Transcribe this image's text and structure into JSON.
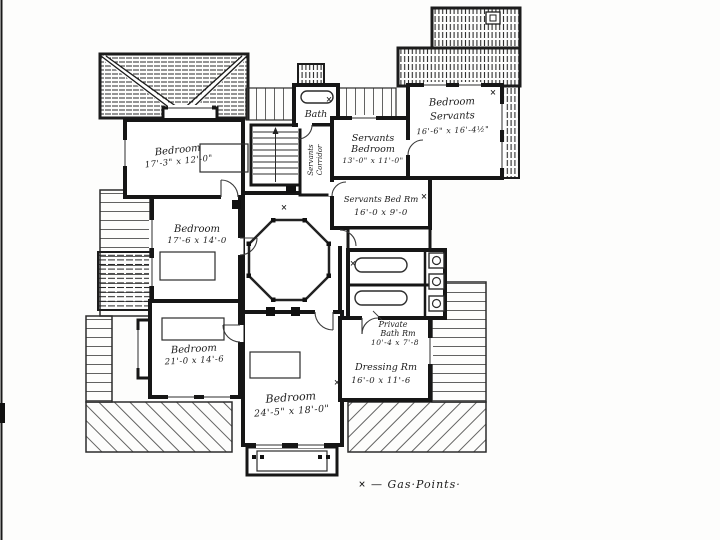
{
  "drawing": {
    "kind": "floor-plan",
    "ink_color": "#1c1c1c",
    "paper_color": "#fdfdfc"
  },
  "rooms": {
    "bedroom_nw": {
      "name": "Bedroom",
      "dims": "17'-3\" x 12'-0\""
    },
    "bedroom_w": {
      "name": "Bedroom",
      "dims": "17'-6 x 14'-0"
    },
    "bedroom_sw": {
      "name": "Bedroom",
      "dims": "21'-0 x 14'-6"
    },
    "bedroom_s": {
      "name": "Bedroom",
      "dims": "24'-5\" x 18'-0\""
    },
    "bath": {
      "name": "Bath"
    },
    "servants_bedroom": {
      "line1": "Servants",
      "line2": "Bedroom",
      "dims": "13'-0\" x 11'-0\""
    },
    "bedroom_servants": {
      "line1": "Bedroom",
      "line2": "Servants",
      "dims": "16'-6\" x 16'-4½\""
    },
    "servants_bed_rm": {
      "name": "Servants Bed Rm",
      "dims": "16'-0 x 9'-0"
    },
    "private_bath": {
      "line1": "Private",
      "line2": "Bath Rm",
      "dims": "10'-4 x 7'-8"
    },
    "dressing_rm": {
      "name": "Dressing Rm",
      "dims": "16'-0 x 11'-6"
    },
    "servants_corridor": {
      "line1": "Servants",
      "line2": "Corridor"
    }
  },
  "legend": {
    "symbol": "×",
    "label": "— Gas·Points·"
  }
}
